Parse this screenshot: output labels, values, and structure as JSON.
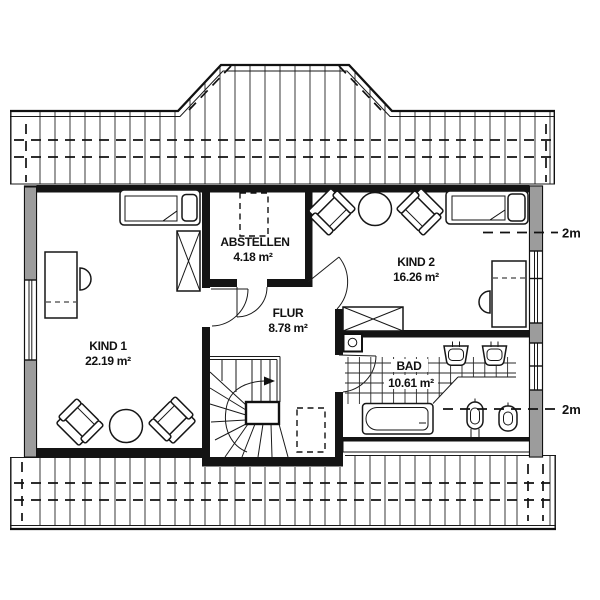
{
  "rooms": [
    {
      "name": "KIND 1",
      "area": "22.19 m²"
    },
    {
      "name": "ABSTELLEN",
      "area": "4.18 m²"
    },
    {
      "name": "FLUR",
      "area": "8.78 m²"
    },
    {
      "name": "KIND 2",
      "area": "16.26 m²"
    },
    {
      "name": "BAD",
      "area": "10.61 m²"
    }
  ],
  "height_markers": {
    "upper": "2m",
    "lower": "2m"
  },
  "colors": {
    "line": "#111111",
    "masonry_gray": "#9c9c9c",
    "background": "#ffffff"
  }
}
